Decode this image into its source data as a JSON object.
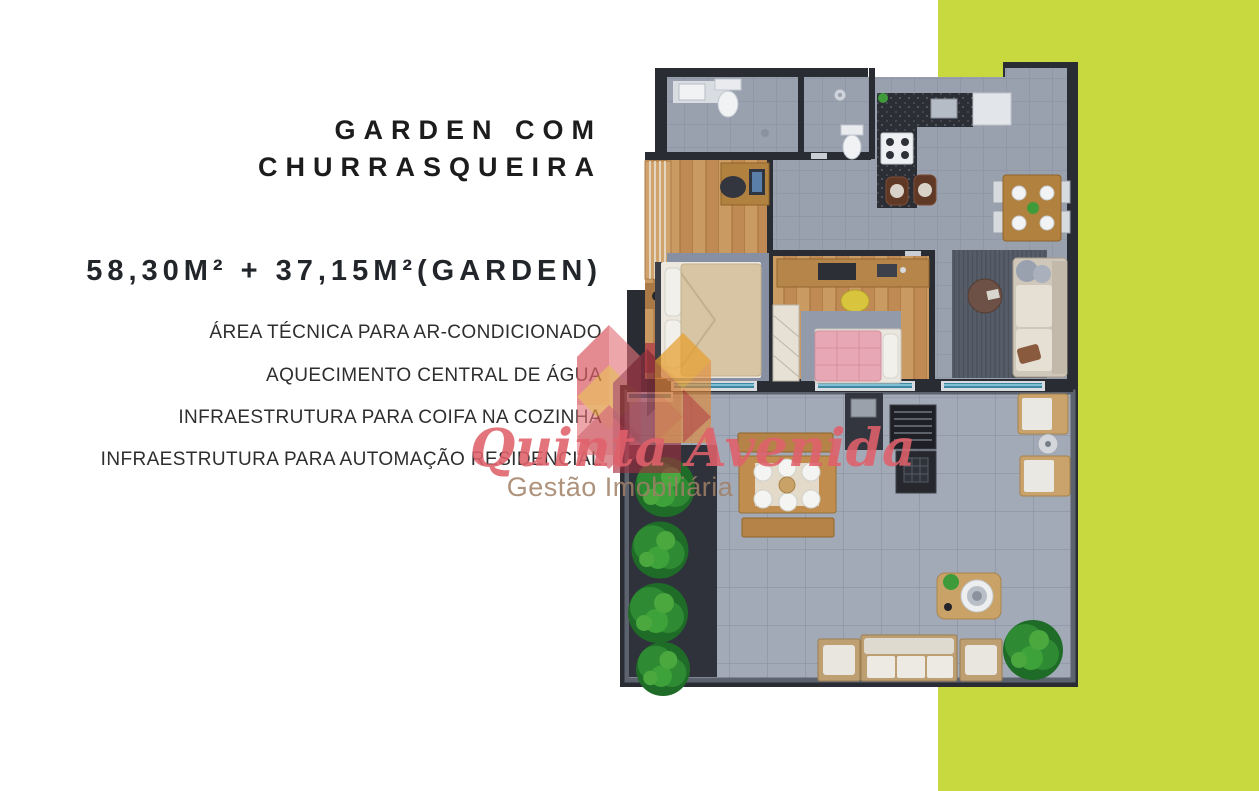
{
  "page": {
    "width": 1259,
    "height": 791
  },
  "colors": {
    "accent": "#c8d93f",
    "wall": "#292c33",
    "title_text": "#1c1c1c",
    "feature_text": "#2e2e2e",
    "watermark_red": "#e0616b",
    "watermark_gray": "#a08066"
  },
  "title": {
    "line1": "GARDEN COM",
    "line2": "CHURRASQUEIRA"
  },
  "area": {
    "label": "58,30M² + 37,15M²(GARDEN)",
    "private": "58,30M²",
    "garden": "37,15M²"
  },
  "features": [
    "ÁREA TÉCNICA PARA AR-CONDICIONADO",
    "AQUECIMENTO CENTRAL DE ÁGUA",
    "INFRAESTRUTURA PARA COIFA NA COZINHA",
    "INFRAESTRUTURA PARA AUTOMAÇÃO RESIDENCIAL"
  ],
  "watermark": {
    "brand": "Quinta Avenida",
    "subtitle": "Gestão Imobiliária"
  },
  "floorplan": {
    "icons": [
      "bathroom-sink",
      "toilet",
      "shower",
      "kitchen-counter",
      "stove",
      "fridge",
      "bar-stools",
      "dining-table",
      "sofa",
      "coffee-table",
      "double-bed",
      "single-bed",
      "desk",
      "wardrobe",
      "window-glass",
      "barbecue-grill",
      "garden-dining-table",
      "lounge-chairs",
      "bistro-table",
      "outdoor-sofa-set",
      "garden-plants"
    ]
  }
}
